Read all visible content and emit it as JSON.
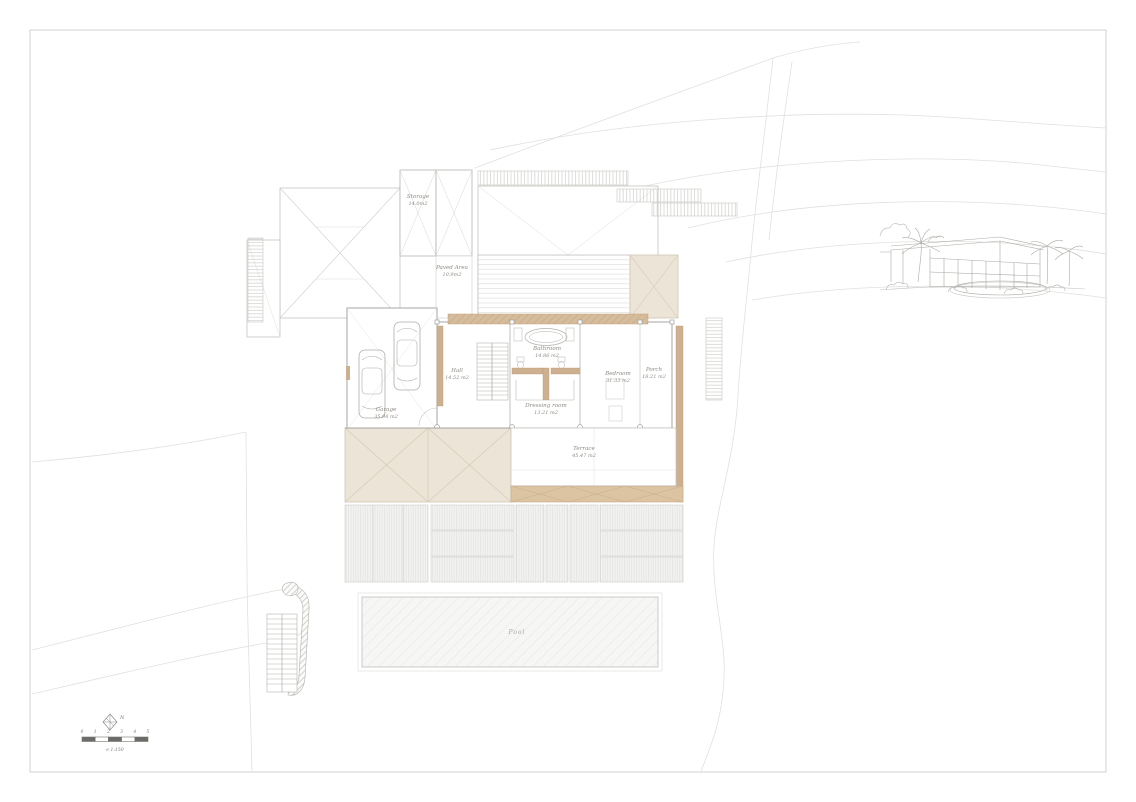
{
  "drawing": {
    "type": "architectural-site-plan",
    "frame_color": "#d2d2cf",
    "line_color": "#bdbdb9",
    "wall_color": "#9f9f9a",
    "tan_color": "#cdb090",
    "beige_fill": "#ece4d6",
    "contour_color": "#e0e0dd",
    "text_color": "#8f8b83"
  },
  "rooms": {
    "storage": {
      "name": "Storage",
      "area": "14.0m2"
    },
    "paved_area": {
      "name": "Paved Area",
      "area": "10.9m2"
    },
    "garage": {
      "name": "Garage",
      "area": "35.98 m2"
    },
    "hall": {
      "name": "Hall",
      "area": "14.52 m2"
    },
    "bathroom": {
      "name": "Bathroom",
      "area": "14.86 m2"
    },
    "dressing_room": {
      "name": "Dressing room",
      "area": "13.21 m2"
    },
    "bedroom": {
      "name": "Bedroom",
      "area": "31.33 m2"
    },
    "porch": {
      "name": "Porch",
      "area": "18.21 m2"
    },
    "terrace": {
      "name": "Terrace",
      "area": "45.47 m2"
    },
    "pool": {
      "name": "Pool"
    }
  },
  "north": {
    "label": "N"
  },
  "scale_bar": {
    "ticks": [
      "0",
      "1",
      "2",
      "3",
      "4",
      "5"
    ],
    "scale_label": "e 1:150"
  }
}
